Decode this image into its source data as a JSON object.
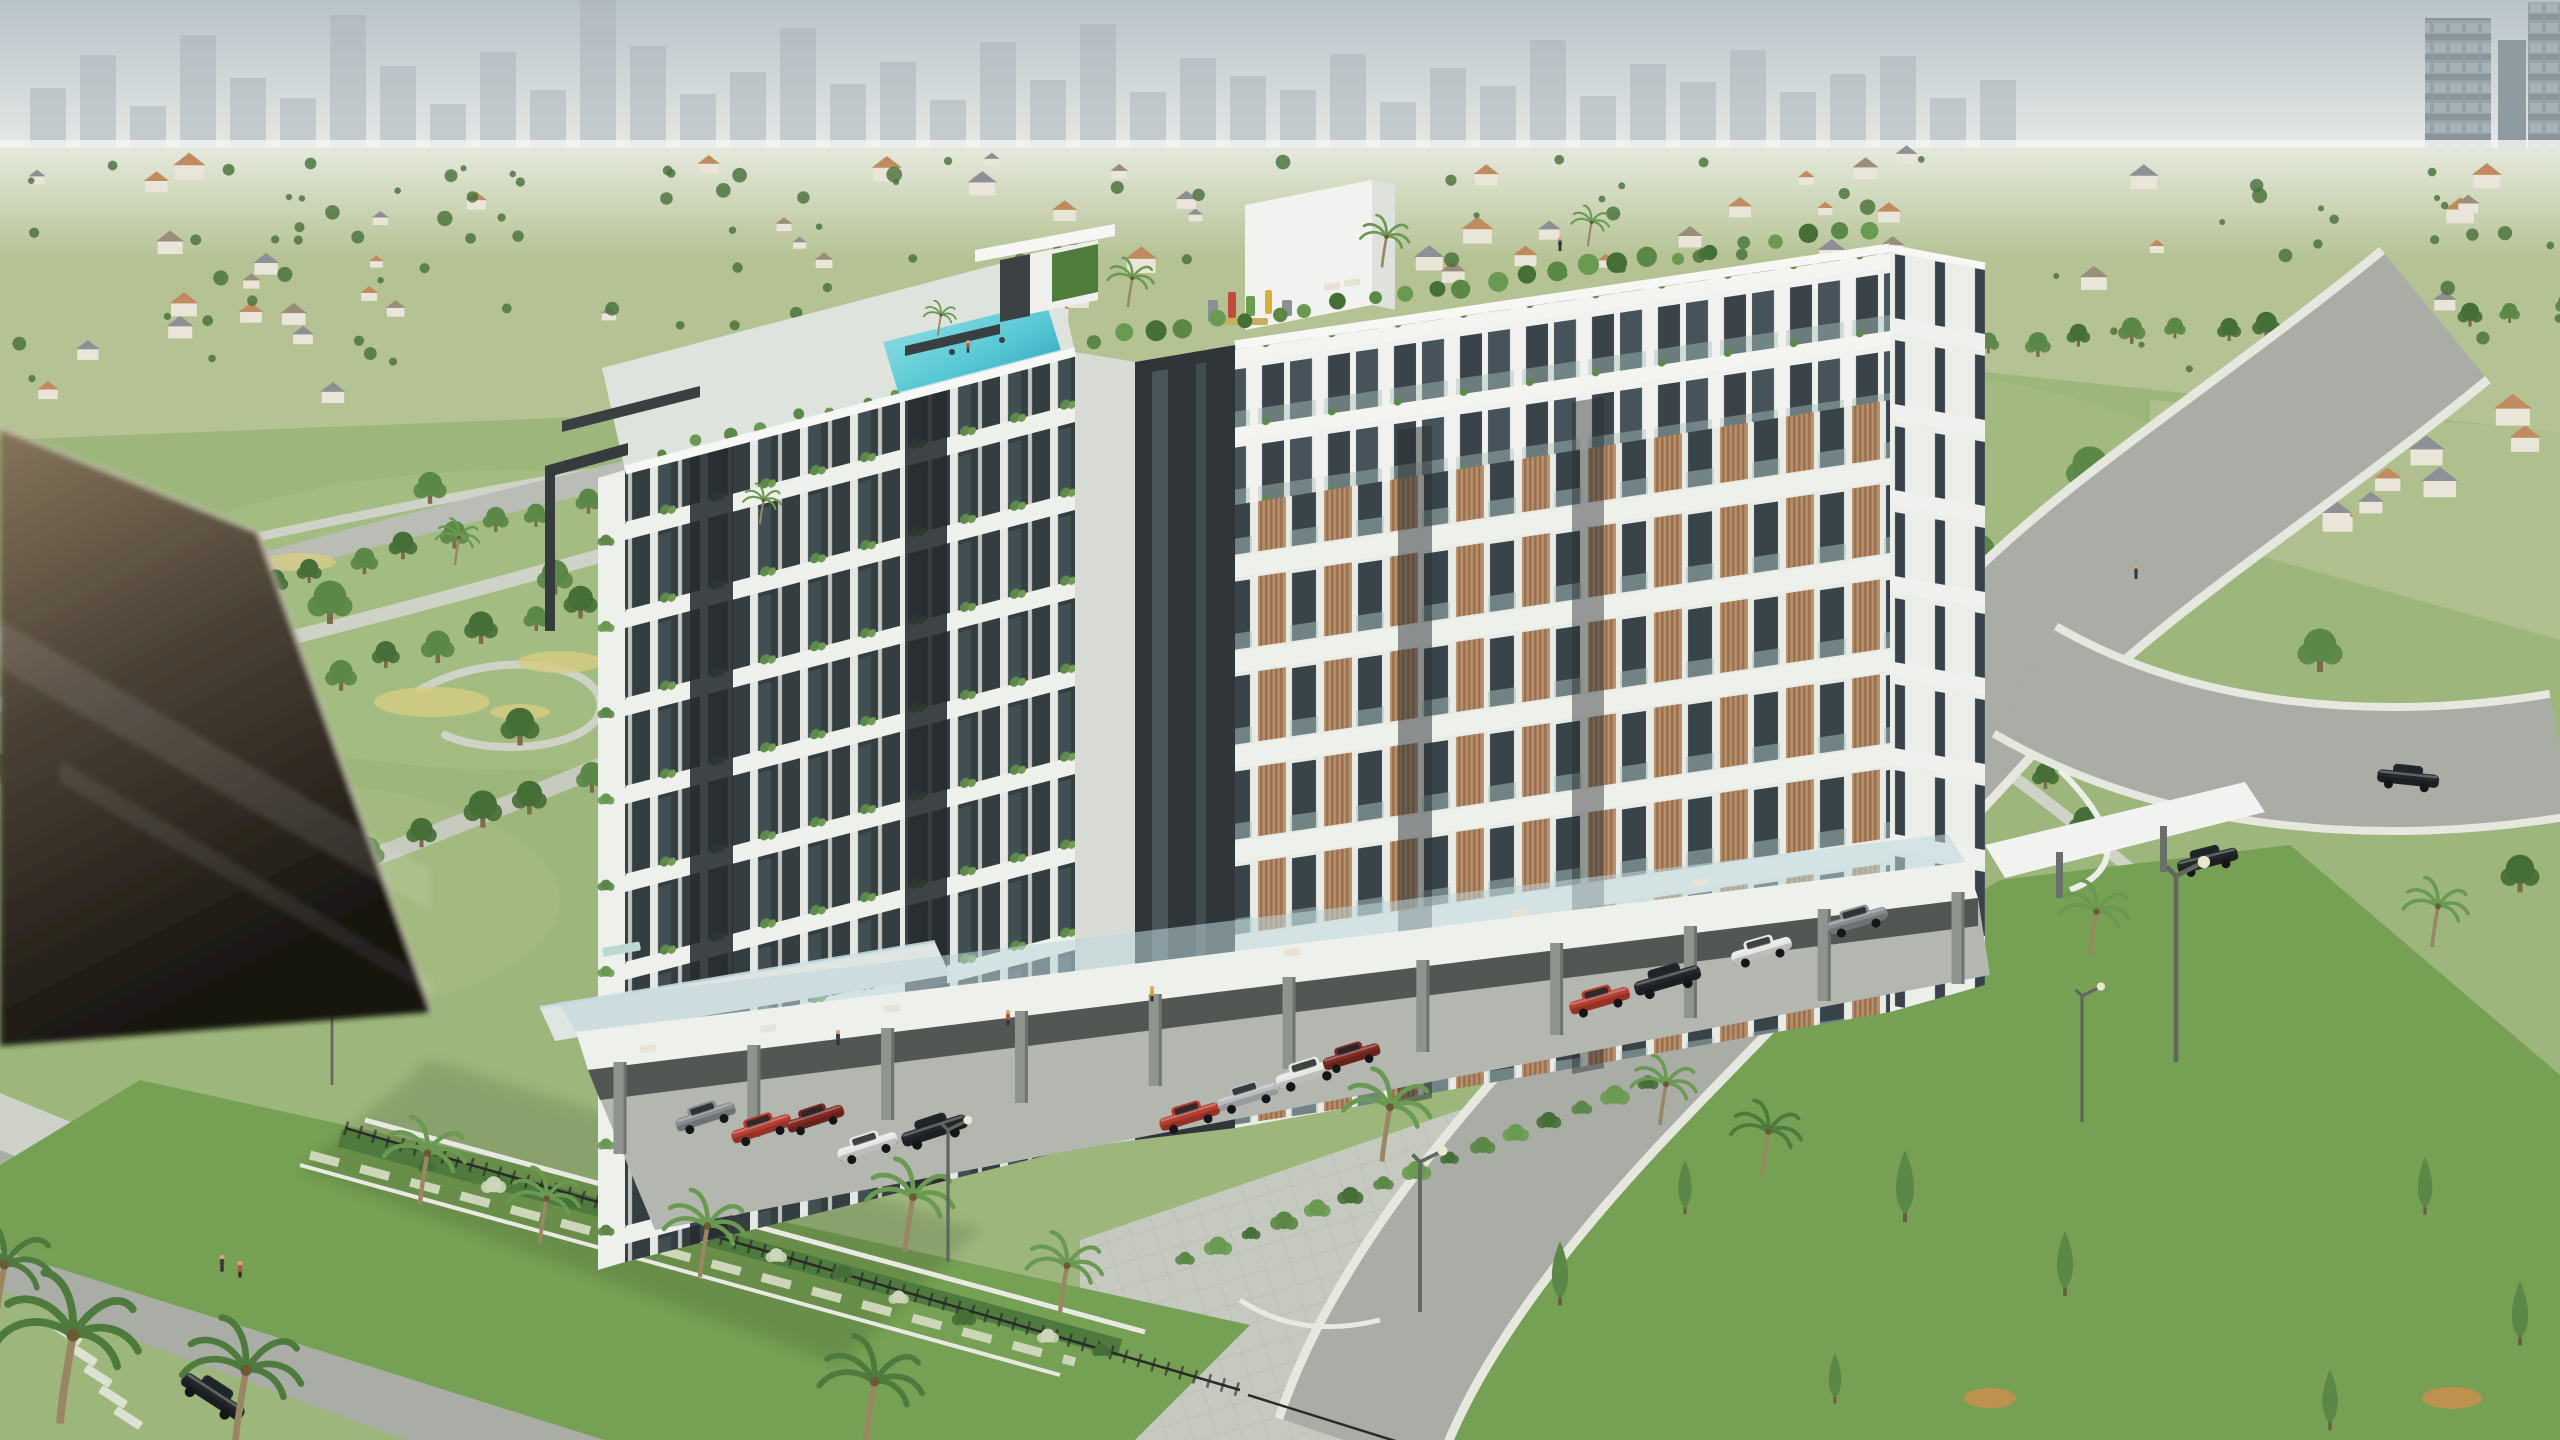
{
  "meta": {
    "type": "aerial-architectural-rendering",
    "subject": "modern-residential-building-with-rooftop-pool-in-green-parkland",
    "canvas": {
      "width": 2560,
      "height": 1440
    }
  },
  "palette": {
    "sky": "#c2cbd0",
    "skyTop": "#b8c3c9",
    "skyline": "#a8b1b8",
    "haze": "#eef1ef",
    "distantField": "#b5c293",
    "parkGrass": "#9cb67b",
    "grassLight": "#aec489",
    "lawnDark": "#76a053",
    "lawnShade": "#5d8743",
    "road": "#a9ada6",
    "roadLight": "#b9bdb5",
    "sidewalk": "#ced1c7",
    "plaza": "#c6c9c0",
    "curb": "#e6e8e0",
    "treeGreen": "#5b8747",
    "treeDark": "#466f38",
    "treeLight": "#79a55c",
    "palmGreen": "#6a9a52",
    "palmDark": "#4e7a3e",
    "facadeWhite": "#eef0ec",
    "facadeShade": "#d9dcd6",
    "parapet": "#f7f8f5",
    "frameDark": "#2f3539",
    "glassDark": "#343e41",
    "glassTint": "#a9c2bd",
    "wood": "#b9906c",
    "woodDark": "#97714f",
    "poolAqua": "#57c8d4",
    "poolDeep": "#2395b4",
    "poolPale": "#9fe4e8",
    "deck": "#dfe3de",
    "columnGrey": "#8f948f",
    "undercroftShadow": "#3a3f3d",
    "carportFloor": "#b4b7af",
    "canopyDark": "#3a3f42",
    "greenWall": "#4e7d3c",
    "fgGlassTop": "#86755a",
    "fgGlassMid": "#4a4135",
    "fgGlassDark": "#15120e",
    "carRed": "#b63d30",
    "carDarkRed": "#7e2a22",
    "carWhite": "#e6e7e4",
    "carSilver": "#b9bdbe",
    "carBlack": "#23262a",
    "carGrey": "#878d8f",
    "personRed": "#b5533c",
    "personYellow": "#d0a93c",
    "personDark": "#3a3e43",
    "houseWall": "#e9e6d9",
    "flowerYellow": "#d6cc82",
    "flowerWhite": "#cdd6b8",
    "orangeShrub": "#c98f4e",
    "tableTop": "#bcd8d2",
    "houseRoofs": [
      "#9a8d7c",
      "#c08b5e",
      "#8d9196"
    ]
  },
  "scene": {
    "skyline": {
      "x0": 30,
      "bar_w": 36,
      "gap": 14,
      "baseline": 150,
      "heights": [
        62,
        95,
        44,
        115,
        72,
        52,
        135,
        84,
        46,
        98,
        60,
        150,
        104,
        56,
        78,
        122,
        66,
        88,
        50,
        108,
        70,
        126,
        58,
        92,
        74,
        60,
        96,
        48,
        82,
        64,
        110,
        54,
        86,
        68,
        100,
        58,
        76,
        94,
        52,
        70
      ]
    },
    "towers_right": [
      {
        "x": 2425,
        "y": 18,
        "w": 66,
        "h": 262
      },
      {
        "x": 2498,
        "y": 40,
        "w": 28,
        "h": 240
      },
      {
        "x": 2528,
        "y": 2,
        "w": 32,
        "h": 300
      }
    ],
    "distant": {
      "seed": 11,
      "houses": 62,
      "trees": 150,
      "y_top": 158,
      "y_span": 250,
      "clusters": [
        {
          "x0": 2180,
          "x1": 2545,
          "y0": 395,
          "y1": 560,
          "n": 13,
          "s": 1.7
        },
        {
          "x0": 40,
          "x1": 520,
          "y0": 300,
          "y1": 400,
          "n": 8,
          "s": 1.3
        }
      ]
    },
    "tree_rows": [
      {
        "p": [
          40,
          655,
          1000,
          390
        ],
        "n": 22,
        "s": 0.9
      },
      {
        "p": [
          0,
          775,
          1120,
          460
        ],
        "n": 24,
        "s": 1.0
      },
      {
        "p": [
          155,
          950,
          1185,
          545
        ],
        "n": 20,
        "s": 1.1
      },
      {
        "p": [
          1935,
          352,
          2560,
          312
        ],
        "n": 14,
        "s": 0.8
      },
      {
        "p": [
          2420,
          330,
          1990,
          672
        ],
        "n": 10,
        "s": 0.9
      },
      {
        "p": [
          1995,
          735,
          2330,
          1085
        ],
        "n": 8,
        "s": 1.0
      },
      {
        "p": [
          2100,
          770,
          2540,
          758
        ],
        "n": 7,
        "s": 0.9
      }
    ],
    "trees": [
      [
        115,
        545,
        1.3
      ],
      [
        330,
        612,
        1.5
      ],
      [
        555,
        585,
        1.2
      ],
      [
        300,
        772,
        1.6
      ],
      [
        95,
        878,
        1.5
      ],
      [
        520,
        735,
        1.3,
        "treeDark"
      ],
      [
        205,
        690,
        1.2,
        "treeLight"
      ],
      [
        430,
        495,
        1.1
      ],
      [
        2090,
        480,
        1.6
      ],
      [
        2230,
        562,
        1.4,
        "treeDark"
      ],
      [
        1980,
        562,
        1.3
      ],
      [
        2320,
        660,
        1.5
      ],
      [
        2435,
        762,
        1.4
      ],
      [
        2520,
        882,
        1.3,
        "treeDark"
      ],
      [
        2052,
        640,
        1.2,
        "treeLight"
      ],
      [
        1952,
        520,
        1.1
      ],
      [
        2240,
        1165,
        1.3
      ],
      [
        1775,
        1320,
        1.2,
        "treeDark"
      ],
      [
        2120,
        1010,
        2.2
      ],
      [
        2300,
        950,
        1.8,
        "treeDark"
      ]
    ],
    "conifers": [
      [
        1560,
        1295,
        1.8
      ],
      [
        1685,
        1205,
        1.5
      ],
      [
        1905,
        1210,
        2.0
      ],
      [
        2065,
        1285,
        1.8
      ],
      [
        2425,
        1205,
        1.6
      ],
      [
        2520,
        1335,
        1.8
      ],
      [
        1835,
        1395,
        1.4
      ],
      [
        2330,
        1420,
        1.7
      ]
    ],
    "palms": [
      [
        420,
        1195,
        1.5
      ],
      [
        540,
        1235,
        1.3
      ],
      [
        700,
        1268,
        1.5
      ],
      [
        905,
        1242,
        1.6
      ],
      [
        1060,
        1305,
        1.4
      ],
      [
        1382,
        1152,
        1.6
      ],
      [
        1660,
        1118,
        1.2
      ],
      [
        1762,
        1168,
        1.3,
        "palmDark"
      ],
      [
        2090,
        948,
        1.3
      ],
      [
        2432,
        940,
        1.2
      ],
      [
        60,
        1408,
        2.6,
        "palmDark"
      ],
      [
        235,
        1432,
        2.2,
        "palmDark"
      ],
      [
        -5,
        1318,
        1.9,
        "palmDark"
      ],
      [
        865,
        1435,
        1.9,
        "palmDark"
      ],
      [
        1128,
        302,
        0.85
      ],
      [
        1382,
        262,
        0.9
      ],
      [
        938,
        332,
        0.6
      ],
      [
        1588,
        242,
        0.7
      ],
      [
        455,
        560,
        0.8
      ],
      [
        760,
        520,
        0.7
      ]
    ],
    "cars": [
      [
        706,
        1118,
        -18,
        1.0,
        "carGrey"
      ],
      [
        762,
        1130,
        -18,
        1.0,
        "carRed"
      ],
      [
        816,
        1120,
        -18,
        0.95,
        "carDarkRed"
      ],
      [
        868,
        1148,
        -18,
        1.0,
        "carWhite"
      ],
      [
        935,
        1132,
        -18,
        1.1,
        "carBlack"
      ],
      [
        1190,
        1118,
        -17,
        1.0,
        "carRed"
      ],
      [
        1248,
        1098,
        -17,
        1.0,
        "carSilver"
      ],
      [
        1308,
        1075,
        -17,
        1.05,
        "carWhite"
      ],
      [
        1352,
        1058,
        -17,
        0.95,
        "carDarkRed"
      ],
      [
        1600,
        1002,
        -16,
        1.0,
        "carRed"
      ],
      [
        1668,
        982,
        -16,
        1.1,
        "carBlack"
      ],
      [
        1762,
        952,
        -16,
        1.0,
        "carWhite"
      ],
      [
        1858,
        922,
        -16,
        1.0,
        "carGrey"
      ],
      [
        2208,
        862,
        -14,
        1.0,
        "carBlack"
      ],
      [
        2408,
        780,
        6,
        1.0,
        "carBlack"
      ],
      [
        212,
        1398,
        33,
        1.15,
        "carBlack"
      ]
    ],
    "loungers": [
      [
        886,
        410,
        -14
      ],
      [
        920,
        402,
        -14
      ],
      [
        954,
        394,
        -14
      ],
      [
        858,
        418,
        -14
      ],
      [
        812,
        430,
        -14
      ]
    ],
    "furniture": [
      [
        648,
        1048,
        -9
      ],
      [
        768,
        1028,
        -9
      ],
      [
        892,
        1008,
        -9
      ],
      [
        1292,
        952,
        -8
      ],
      [
        1520,
        912,
        -8
      ],
      [
        1700,
        882,
        -8
      ],
      [
        1332,
        286,
        -8
      ],
      [
        1352,
        282,
        -8
      ]
    ],
    "people": [
      [
        222,
        1268,
        1.2,
        "personDark"
      ],
      [
        240,
        1274,
        1.2,
        "personRed"
      ],
      [
        838,
        1042,
        1.1,
        "personDark"
      ],
      [
        1008,
        1022,
        1.1,
        "personRed"
      ],
      [
        1152,
        998,
        1.1,
        "personYellow"
      ],
      [
        1560,
        248,
        1.0,
        "personDark"
      ],
      [
        2136,
        576,
        1.0,
        "personDark"
      ],
      [
        968,
        350,
        0.9,
        "personRed"
      ]
    ],
    "swimmers": [
      [
        952,
        352
      ],
      [
        1002,
        340
      ]
    ],
    "lights": [
      [
        948,
        1262,
        1.1
      ],
      [
        1420,
        1312,
        1.25
      ],
      [
        2082,
        1122,
        1.05
      ],
      [
        2176,
        1062,
        1.55
      ],
      [
        332,
        1085,
        0.9
      ]
    ],
    "columns": {
      "x1": 620,
      "y1": 1062,
      "x2": 1958,
      "y2": 892,
      "n": 11,
      "h": 92
    },
    "crosswalk": {
      "x": 58,
      "y": 1322,
      "n": 5,
      "angle": 33,
      "dx": 15,
      "dy": 21,
      "w": 30,
      "h": 9
    },
    "roof_garden": {
      "x1": 1092,
      "y1": 340,
      "x2": 1866,
      "y2": 228,
      "n": 26
    },
    "rail_planters": {
      "x1": 660,
      "y1": 452,
      "x2": 900,
      "y2": 392,
      "n": 8
    },
    "shrub_strip": {
      "x1": 1185,
      "y1": 1258,
      "x2": 1648,
      "y2": 1082,
      "n": 15
    },
    "flower_shrubs": {
      "x1": 428,
      "y1": 1166,
      "x2": 1108,
      "y2": 1352,
      "n": 11
    },
    "balcony_bushes": {
      "x": 606,
      "y1": 540,
      "y2": 1230,
      "n": 9
    },
    "flowerbeds": [
      [
        432,
        702,
        58,
        15
      ],
      [
        560,
        662,
        42,
        11
      ],
      [
        300,
        562,
        36,
        9
      ],
      [
        520,
        712,
        30,
        8
      ]
    ],
    "orange_shrubs": [
      [
        1990,
        1398,
        26,
        10
      ],
      [
        2452,
        1398,
        30,
        11
      ],
      [
        1348,
        980,
        16,
        7
      ]
    ],
    "playground_bits": [
      {
        "x": 1208,
        "y": 300,
        "w": 10,
        "h": 22,
        "c": "#8b9094"
      },
      {
        "x": 1228,
        "y": 292,
        "w": 8,
        "h": 26,
        "c": "#c24b3a"
      },
      {
        "x": 1246,
        "y": 296,
        "w": 9,
        "h": 20,
        "c": "#6a9e4f"
      },
      {
        "x": 1265,
        "y": 290,
        "w": 7,
        "h": 24,
        "c": "#d8b13a"
      },
      {
        "x": 1282,
        "y": 300,
        "w": 10,
        "h": 16,
        "c": "#8b9094"
      },
      {
        "x": 1222,
        "y": 318,
        "w": 46,
        "h": 7,
        "c": "#c8b05a"
      }
    ]
  }
}
